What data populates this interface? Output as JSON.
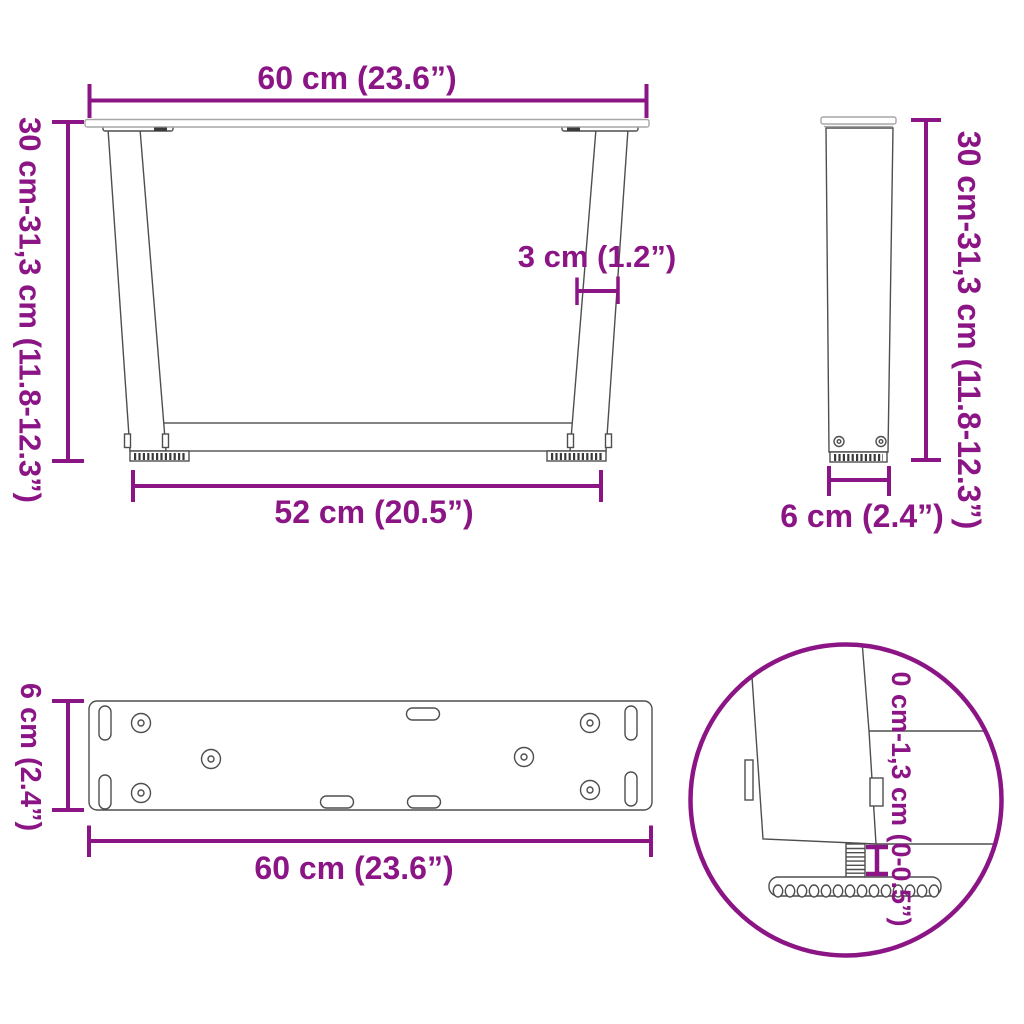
{
  "colors": {
    "dimension_magenta": "#8c1586",
    "drawing_line": "#4e4e4e",
    "drawing_line_light": "#a6a6a6",
    "background": "#ffffff"
  },
  "front_view": {
    "width_top": "60 cm (23.6”)",
    "height_range": "30 cm-31,3 cm (11.8-12.3”)",
    "thickness": "3 cm (1.2”)",
    "width_bottom": "52 cm (20.5”)"
  },
  "side_view": {
    "height_range": "30 cm-31,3 cm (11.8-12.3”)",
    "depth": "6 cm (2.4”)"
  },
  "plate_view": {
    "depth": "6 cm (2.4”)",
    "width": "60 cm (23.6”)"
  },
  "detail_view": {
    "adjust_range": "0 cm-1,3 cm (0-0.5”)"
  }
}
